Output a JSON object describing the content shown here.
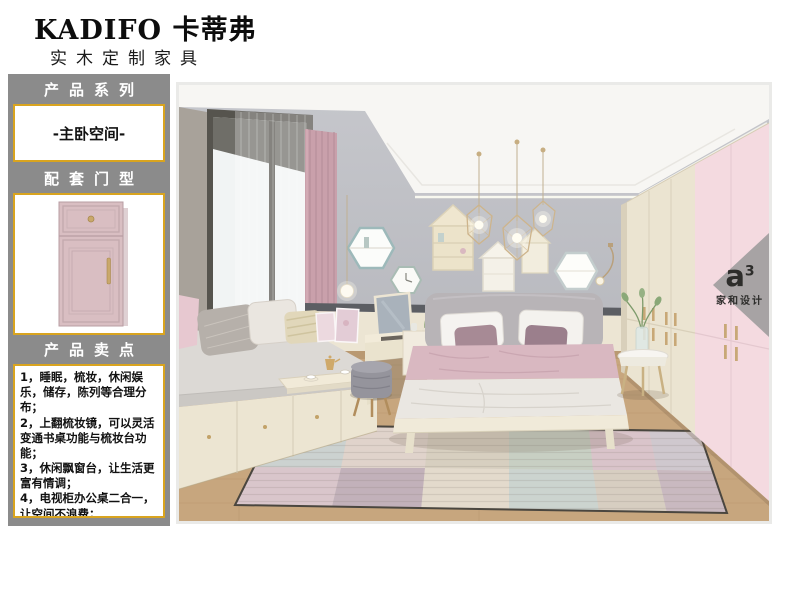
{
  "header": {
    "brand": "KADIFO 卡蒂弗",
    "subtitle": "实木定制家具"
  },
  "sidebar": {
    "product_series_title": "产品系列",
    "series_name": "-主卧空间-",
    "door_type_title": "配套门型",
    "selling_points_title": "产品卖点",
    "selling_points": [
      "1，睡眠，梳妆，休闲娱乐，储存，陈列等合理分布；",
      "2，上翻梳妆镜，可以灵活变通书桌功能与梳妆台功能；",
      "3，休闲飘窗台，让生活更富有情调；",
      "4，电视柜办公桌二合一，让空间不浪费；"
    ]
  },
  "watermark": {
    "logo": "a",
    "logo_sup": "3",
    "name": "家和设计"
  },
  "colors": {
    "sidebar_gray": "#8b8b8b",
    "accent_gold": "#d9a41f",
    "door_pink": "#d9bec2",
    "wall_gray": "#b9bac0",
    "wardrobe_pink": "#f4dae0",
    "wardrobe_cream": "#ebe4d1",
    "curtain_pink": "#c9a0ab",
    "floor_wood": "#c7a67e",
    "watermark_gray": "#969696",
    "text_dark": "#141414"
  }
}
